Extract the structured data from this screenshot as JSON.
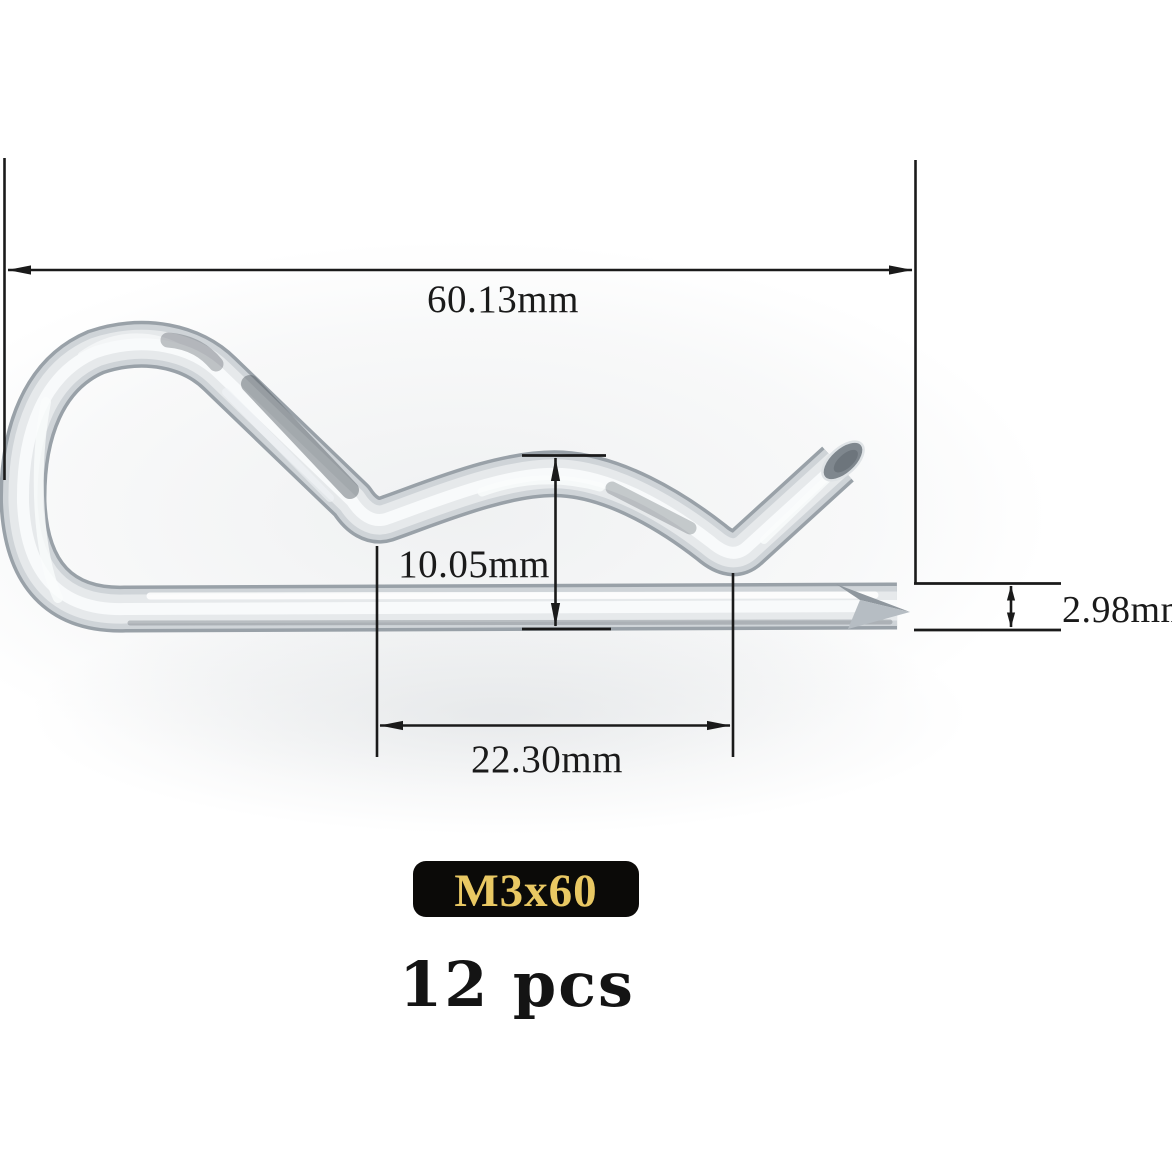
{
  "product": {
    "type_label": "R-clip hairpin cotter pin dimensional diagram",
    "size_label": "M3x60",
    "quantity": "12 pcs"
  },
  "dimensions": {
    "overall_length": "60.13mm",
    "bend_height": "10.05mm",
    "wire_diameter": "2.98mm",
    "inner_span": "22.30mm"
  },
  "colors": {
    "dimension_lines": "#1a1a1a",
    "badge_background": "#0b0a08",
    "badge_text": "#e9c863",
    "quantity_text": "#141414",
    "metal_edge": "#99a1a8",
    "metal_mid": "#cfd4d8",
    "metal_light": "#e6e9eb",
    "metal_core": "#f8fafb"
  }
}
